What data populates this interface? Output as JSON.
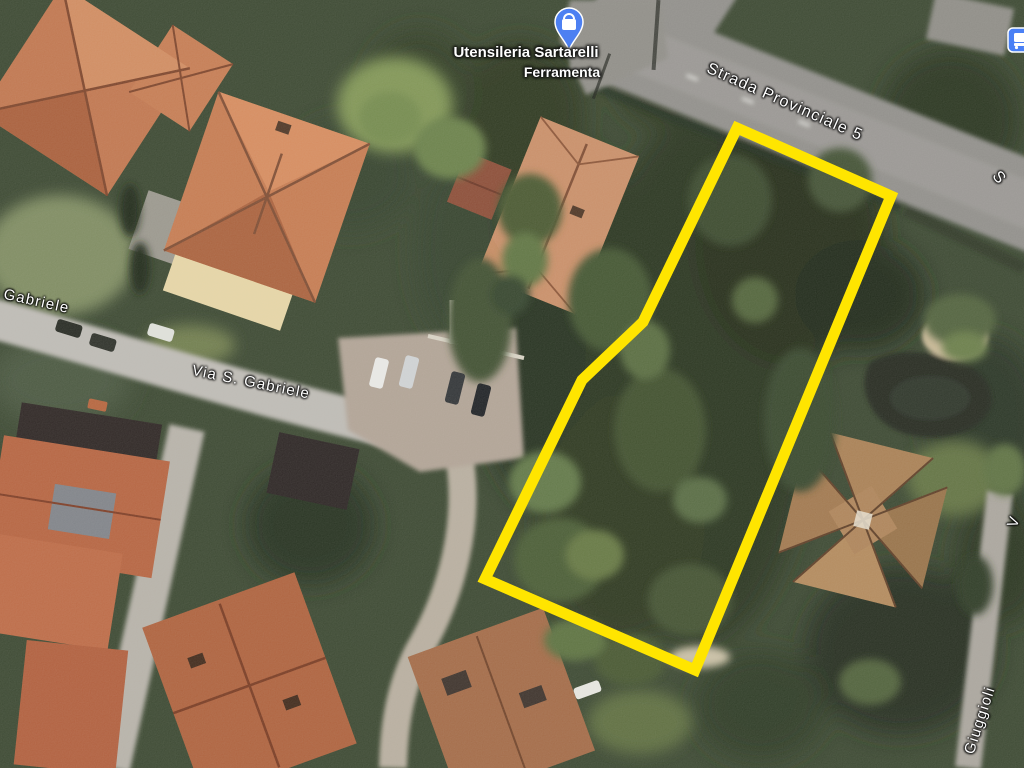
{
  "map": {
    "view_type": "satellite",
    "labels": {
      "sp5": "Strada Provinciale 5",
      "via_s_gabriele": "Via S. Gabriele",
      "s_gabriele": "S. Gabriele",
      "giuggioli": "Giuggioli",
      "partial_top_right": "S",
      "partial_bottom_right": "V"
    },
    "poi": {
      "name": "Utensileria Sartarelli",
      "category": "Ferramenta",
      "pin_icon": "shopping-bag-pin"
    },
    "transit_icon": "bus-stop",
    "parcel_outline": {
      "color": "#FFE500",
      "stroke_width": 11,
      "points": "737,128 891,196 695,670 485,579 582,380 643,322",
      "vertices": [
        [
          737,
          128
        ],
        [
          891,
          196
        ],
        [
          695,
          670
        ],
        [
          485,
          579
        ],
        [
          582,
          380
        ],
        [
          643,
          322
        ]
      ]
    },
    "colors": {
      "vegetation_dark": "#242e1c",
      "vegetation_mid": "#3c4c2d",
      "road_major": "#8f8d89",
      "road_minor": "#b9b5ae",
      "roof_terracotta": "#c0744c",
      "roof_brown": "#a87e52",
      "label_text": "#ffffff",
      "pin_blue": "#4d80f2",
      "transit_blue": "#4a80f5"
    }
  }
}
